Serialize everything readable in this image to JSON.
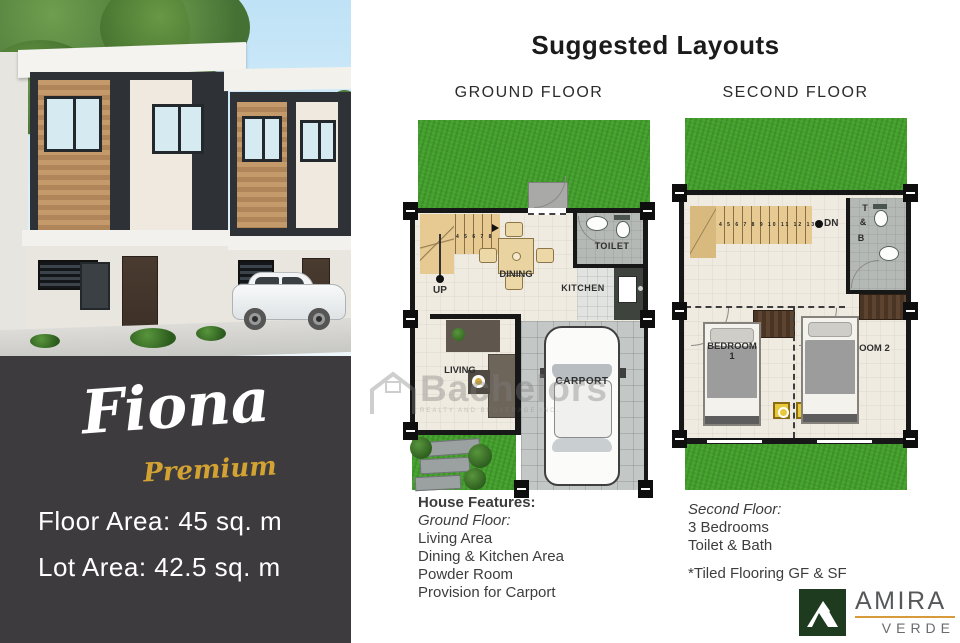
{
  "brand_panel": {
    "model_name": "Fiona",
    "model_tier": "Premium",
    "floor_area": "Floor Area: 45 sq. m",
    "lot_area": "Lot Area: 42.5 sq. m"
  },
  "layouts": {
    "title": "Suggested Layouts",
    "ground": {
      "header": "GROUND FLOOR",
      "stair_numbers": "4 5 6 7 8",
      "labels": {
        "up": "UP",
        "dining": "DINING",
        "toilet": "TOILET",
        "kitchen": "KITCHEN",
        "living": "LIVING",
        "carport": "CARPORT"
      }
    },
    "second": {
      "header": "SECOND FLOOR",
      "stair_numbers": "4 5 6 7 8 9 10 11 12 13",
      "labels": {
        "dn": "DN",
        "t": "T",
        "amp": "&",
        "b": "B",
        "bedroom1": "BEDROOM 1",
        "bedroom2": "BEDROOM 2"
      }
    }
  },
  "features": {
    "ground": {
      "heading": "House Features:",
      "subheading": "Ground Floor:",
      "items": [
        "Living Area",
        "Dining & Kitchen Area",
        "Powder Room",
        "Provision for Carport"
      ]
    },
    "second": {
      "subheading": "Second Floor:",
      "items": [
        "3 Bedrooms",
        "Toilet & Bath"
      ],
      "note": "*Tiled Flooring GF & SF"
    }
  },
  "developer_logo": {
    "name": "AMIRA",
    "subname": "VERDE"
  },
  "watermark": {
    "text": "Bachelors",
    "subtext": "REALTY AND BROKERAGE INC."
  },
  "colors": {
    "panel_dark": "#3d3b3d",
    "accent_gold": "#d2a233",
    "grass_green": "#44a02c",
    "logo_green": "#1e3a1f",
    "underline_gold": "#d79b3c"
  }
}
